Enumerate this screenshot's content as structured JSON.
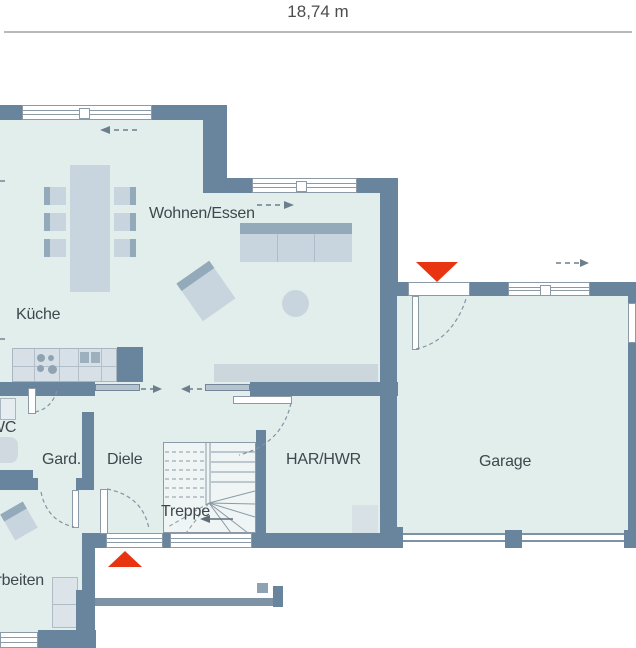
{
  "dimension": {
    "label": "18,74 m"
  },
  "rooms": {
    "wohnen_essen": "Wohnen/Essen",
    "kueche": "Küche",
    "wc": "WC",
    "garderobe": "Gard.",
    "diele": "Diele",
    "treppe": "Treppe",
    "har_hwr": "HAR/HWR",
    "garage": "Garage",
    "arbeiten": "Arbeiten"
  },
  "colors": {
    "wall": "#68859d",
    "floor": "#e2eeec",
    "accent_red": "#e93412",
    "furniture": "#c9d5de",
    "furniture_dark": "#93aaba",
    "window_line": "#8b9aa6",
    "text": "#3f474c",
    "dim_line": "#b9b9b9",
    "stairs_bg": "#eef5f4",
    "panel": "#b7c4ce"
  }
}
